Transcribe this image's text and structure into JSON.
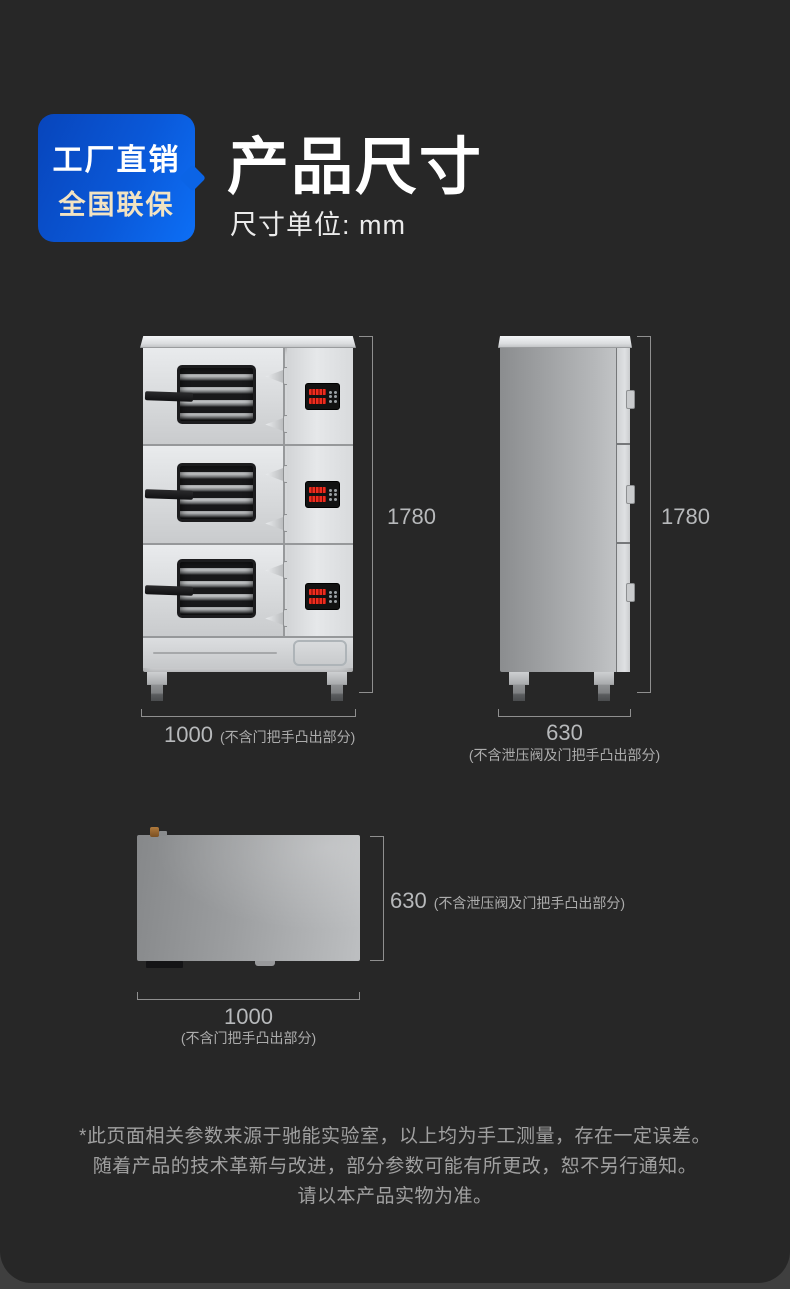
{
  "header": {
    "badge": {
      "line1": "工厂直销",
      "line2": "全国联保"
    },
    "title": "产品尺寸",
    "subtitle": "尺寸单位: mm"
  },
  "front_view": {
    "height_value": "1780",
    "width_value": "1000",
    "width_note": "(不含门把手凸出部分)"
  },
  "side_view": {
    "height_value": "1780",
    "width_value": "630",
    "width_note": "(不含泄压阀及门把手凸出部分)"
  },
  "top_view": {
    "depth_value": "630",
    "depth_note": "(不含泄压阀及门把手凸出部分)",
    "width_value": "1000",
    "width_note": "(不含门把手凸出部分)"
  },
  "disclaimer": {
    "line1": "*此页面相关参数来源于驰能实验室，以上均为手工测量，存在一定误差。",
    "line2": "随着产品的技术革新与改进，部分参数可能有所更改，恕不另行通知。",
    "line3": "请以本产品实物为准。"
  },
  "colors": {
    "card_bg": "#272727",
    "accent_blue": "#0d6ff6",
    "badge_gold": "#f2e3c2",
    "dimension_text": "#b7b9bb",
    "led_red": "#ee2c1e"
  }
}
